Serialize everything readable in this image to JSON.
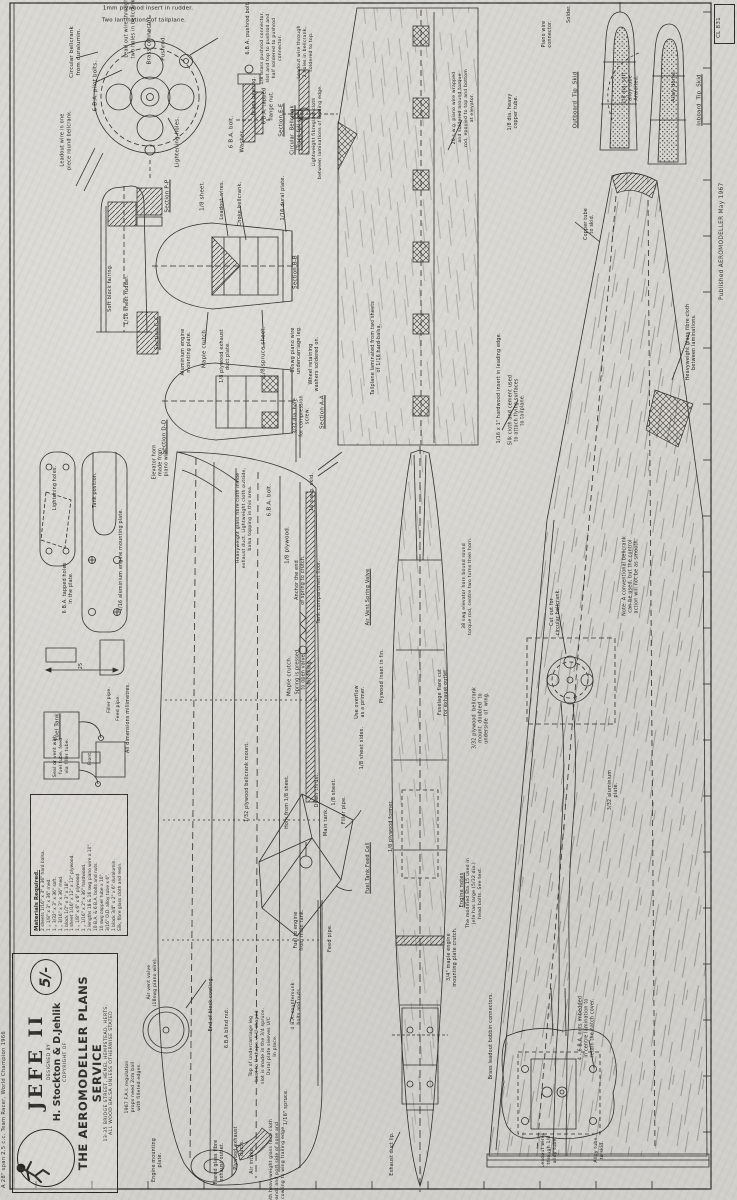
{
  "colors": {
    "paper": "#d6d4cf",
    "ink": "#2e2d2a"
  },
  "page": {
    "plan_number": "CL 831",
    "published": "Published  AEROMODELLER   May 1967",
    "margin_note": "A 28\" span 2.5 c.c. Team Racer, World Champion 1966"
  },
  "title_block": {
    "title": "JEFE II",
    "designed_by_label": "DESIGNED BY",
    "designers": "H. Stockton & D.Jehlik",
    "copyright_label": "COPYRIGHT OF",
    "service": "THE AEROMODELLER PLANS SERVICE",
    "address": "13-35 BRIDGE STREET, HEMEL HEMPSTEAD, HERTS.",
    "note": "ALL WOOD BALSA UNLESS OTHERWISE STATED",
    "price": "5/-"
  },
  "materials": {
    "heading": "Materials  Required.",
    "items": [
      "2 sheets 1/16\" x 3\" x 36\" hard balsa.",
      "1    „    1/8\" x 3\" x 36\" med.",
      "1    „    3/32\" x 3\" x 36\" soft.",
      "1    „    3/16\" x 3\" x 36\" med.",
      "1 block 1/2\" x 3\" x 18\".",
      "1 sheet 1/16\" x 12\" x 12\" plywood.",
      "1    „    1/8\" x 6\" x 6\" plywood.",
      "1    „    1/16\" x 2\" x 36\" hardwood.",
      "2 lengths 18 & 16 swg piano wire x 10\".",
      "10 B.A. & 6 B.A. bolts and nuts.",
      "10 swg copper tube x 10\".",
      "3/16\" O.D. alloy tube x 6\".",
      "1 block 3/4\" x 2\" x 6\" duralumin.",
      "Silk, fibre glass cloth and resin."
    ]
  },
  "labels": [
    {
      "t": "1mm plywood insert in rudder.",
      "x": 148,
      "y": 9,
      "r": 0
    },
    {
      "t": "Two laminations of tailplane.",
      "x": 144,
      "y": 21,
      "r": 0
    },
    {
      "t": "Circular bellcrank\nfrom duralumin.",
      "x": 76,
      "y": 52
    },
    {
      "t": "6 B.A. pilot bolts.",
      "x": 96,
      "y": 86
    },
    {
      "t": "Lead out wire through\ntwo holes in bellcrank.",
      "x": 130,
      "y": 28,
      "fs": 5
    },
    {
      "t": "Brass connector.",
      "x": 150,
      "y": 40
    },
    {
      "t": "Pushrod.",
      "x": 164,
      "y": 48
    },
    {
      "t": "Leadout wire in one\npiece round bellcrank.",
      "x": 66,
      "y": 140,
      "fs": 5
    },
    {
      "t": "Lightening holes.",
      "x": 178,
      "y": 142
    },
    {
      "t": "6.B.A. pushrod bolt.",
      "x": 248,
      "y": 28,
      "fs": 5
    },
    {
      "t": "1/8 brass pushrod connector,\nslot and top to pushrod and\nhalf soldered to pushrod\nconnector.",
      "x": 272,
      "y": 48,
      "fs": 4.6
    },
    {
      "t": "Leadout wire through\n2 holes in bellcrank,\nsoldered to top.",
      "x": 306,
      "y": 52,
      "fs": 4.6
    },
    {
      "t": "6 B.A. bolt.",
      "x": 232,
      "y": 132
    },
    {
      "t": "Washer.",
      "x": 243,
      "y": 141
    },
    {
      "t": "Brass bearing.",
      "x": 254,
      "y": 96,
      "fs": 5
    },
    {
      "t": "6 B.A. tapped\nflange nut.",
      "x": 268,
      "y": 106,
      "fs": 5
    },
    {
      "t": "Section E-E",
      "x": 282,
      "y": 120,
      "u": 1
    },
    {
      "t": "Circular  Bellcrank\n(Trace full size)",
      "x": 296,
      "y": 130,
      "fs": 5,
      "u": 1
    },
    {
      "t": "Lightweight fibreglass cloth\nbetween laminations of leading edge.",
      "x": 318,
      "y": 132,
      "fs": 4.6
    },
    {
      "t": "Section P-P",
      "x": 168,
      "y": 196,
      "u": 1
    },
    {
      "t": "1/8 sheet.",
      "x": 203,
      "y": 196
    },
    {
      "t": "Leadout wires.",
      "x": 222,
      "y": 200,
      "fs": 5
    },
    {
      "t": "Choke bellcrank.",
      "x": 240,
      "y": 204,
      "fs": 5
    },
    {
      "t": "1/16 dural plate.",
      "x": 283,
      "y": 198,
      "fs": 5
    },
    {
      "t": "Section C-C",
      "x": 158,
      "y": 333,
      "u": 1
    },
    {
      "t": "Section D-D",
      "x": 165,
      "y": 437,
      "u": 1
    },
    {
      "t": "Soft block fairing.",
      "x": 110,
      "y": 288,
      "fs": 5
    },
    {
      "t": "1/16 sheet rudder.",
      "x": 127,
      "y": 300,
      "fs": 5
    },
    {
      "t": "Aluminium engine\nmounting plate.",
      "x": 187,
      "y": 352,
      "fs": 4.8
    },
    {
      "t": "Maple crutch.",
      "x": 205,
      "y": 348
    },
    {
      "t": "1/8 plywood exhaust\nduct plate.",
      "x": 226,
      "y": 356,
      "fs": 4.8
    },
    {
      "t": "1/8 spruce sheet.",
      "x": 264,
      "y": 352
    },
    {
      "t": "10swg piano wire\nundercarriage leg.",
      "x": 297,
      "y": 350,
      "fs": 4.8
    },
    {
      "t": "Wheel retaining\nwashers soldered on.",
      "x": 315,
      "y": 364,
      "fs": 4.8
    },
    {
      "t": "Section B-B",
      "x": 296,
      "y": 272,
      "u": 1
    },
    {
      "t": "Section A-A",
      "x": 323,
      "y": 412,
      "u": 1
    },
    {
      "t": "3/32 dia. hole\nfor compression\nscrew.",
      "x": 303,
      "y": 416,
      "fs": 4.8
    },
    {
      "t": "Tailplane laminated from two sheets\nof 1/16 hard balsa.",
      "x": 377,
      "y": 348,
      "fs": 4.8
    },
    {
      "t": "20 s.w.g. piano wire wrapped\nand soldered around torque\nrod, epoxied to top and bottom\nat elevator.",
      "x": 464,
      "y": 108,
      "fs": 4.6
    },
    {
      "t": "Piano wire\nconnector.",
      "x": 548,
      "y": 34,
      "fs": 4.8
    },
    {
      "t": "Solder.",
      "x": 570,
      "y": 14,
      "fs": 4.8
    },
    {
      "t": "1/8 dia. heavy\ncopper tube.",
      "x": 514,
      "y": 112,
      "fs": 4.8
    },
    {
      "t": "Outboard  Tip  Skid",
      "x": 576,
      "y": 100,
      "u": 1
    },
    {
      "t": "Inboard  Tip  Skid",
      "x": 700,
      "y": 100,
      "u": 1
    },
    {
      "t": "1/8 dia. soft\nalloy tube\nAraldited.",
      "x": 632,
      "y": 88,
      "fs": 4.8
    },
    {
      "t": "Alloy dome.",
      "x": 674,
      "y": 86,
      "fs": 5
    },
    {
      "t": "Copper tube\nto skid.",
      "x": 590,
      "y": 224,
      "fs": 4.8
    },
    {
      "t": "Heavyweight glass fibre cloth\nbetween laminations.",
      "x": 692,
      "y": 342,
      "fs": 4.8
    },
    {
      "t": "1/16 x 1\" hardwood insert in leading edge.",
      "x": 500,
      "y": 388,
      "fs": 4.8
    },
    {
      "t": "Silk cloth and cement used\nto attach flying surfaces\nto tailplane.",
      "x": 518,
      "y": 410,
      "fs": 4.8
    },
    {
      "t": "Note: A conventional bellcrank\ncan be used, but the control\naction will not be as smooth.",
      "x": 632,
      "y": 576,
      "fs": 4.8
    },
    {
      "t": "Cut out for\ncircular bellcrank.",
      "x": 556,
      "y": 612,
      "fs": 4.8
    },
    {
      "t": "38 swg elevator horn bound round\ntorque rod, centre two turns then horn.",
      "x": 468,
      "y": 586,
      "fs": 4.6
    },
    {
      "t": "3/32 plywood  bellcrank\nmount  doubled  to\nunderside  of  wing.",
      "x": 482,
      "y": 718,
      "fs": 4.8
    },
    {
      "t": "3/32 aluminium\nplate.",
      "x": 614,
      "y": 790,
      "fs": 4.8
    },
    {
      "t": "Elevator horn\nmade from\npiano wire.",
      "x": 162,
      "y": 462,
      "fs": 4.8
    },
    {
      "t": "Heavyweight glass fibre cloth inside\nexhaust duct. Lightweight cloth outside,\nbalsa topping in this area.",
      "x": 245,
      "y": 518,
      "fs": 4.6
    },
    {
      "t": "6.B.A. bolt.",
      "x": 270,
      "y": 500
    },
    {
      "t": "16 s.w.g. skid.",
      "x": 312,
      "y": 492,
      "fs": 5
    },
    {
      "t": "1/8 plywood.",
      "x": 288,
      "y": 545
    },
    {
      "t": "Anchor the end\nof spring to crutch.",
      "x": 301,
      "y": 580,
      "fs": 4.8
    },
    {
      "t": "Tank compartment floor.",
      "x": 320,
      "y": 592,
      "fs": 4.8
    },
    {
      "t": "Maple crutch.",
      "x": 290,
      "y": 676
    },
    {
      "t": "Spring is pressed\nto open valve\nfor filling.",
      "x": 305,
      "y": 672,
      "fs": 4.8
    },
    {
      "t": "Use overflow\nas a primer.",
      "x": 361,
      "y": 702,
      "fs": 4.8
    },
    {
      "t": "Air Vent Spring Valve",
      "x": 368,
      "y": 597,
      "u": 1,
      "fs": 5
    },
    {
      "t": "Plywood inset in fin.",
      "x": 382,
      "y": 676,
      "fs": 5
    },
    {
      "t": "Fuselage flare cut\nfor exhaust outlet.",
      "x": 444,
      "y": 692,
      "fs": 4.8
    },
    {
      "t": "1/8 sheet sides.",
      "x": 362,
      "y": 748,
      "fs": 5
    },
    {
      "t": "Down thrust.",
      "x": 317,
      "y": 790,
      "fs": 5
    },
    {
      "t": "1/8 sheet.",
      "x": 334,
      "y": 792,
      "fs": 5
    },
    {
      "t": "Main tank.",
      "x": 326,
      "y": 822,
      "fs": 5
    },
    {
      "t": "Filler pipe.",
      "x": 344,
      "y": 810,
      "fs": 5
    },
    {
      "t": "Fuel Tank Feed Cell",
      "x": 368,
      "y": 868,
      "u": 1,
      "fs": 5
    },
    {
      "t": "1/32 plywood bellcrank mount.",
      "x": 248,
      "y": 782,
      "fs": 4.8
    },
    {
      "t": "Horn from 1/8 sheet.",
      "x": 288,
      "y": 802,
      "fs": 4.8
    },
    {
      "t": "Fuel to engine\nfrom main tank.",
      "x": 300,
      "y": 930,
      "fs": 4.8
    },
    {
      "t": "Feed pipe.",
      "x": 330,
      "y": 938,
      "fs": 5
    },
    {
      "t": "1/8 plywood former.",
      "x": 392,
      "y": 826,
      "fs": 4.8
    },
    {
      "t": "Engine notes",
      "x": 462,
      "y": 890,
      "u": 1,
      "fs": 5
    },
    {
      "t": "The modified Eta 15 used in\nJefe has large (5/32 dia.)\nhead bolts. See text.",
      "x": 475,
      "y": 893,
      "fs": 4.6
    },
    {
      "t": "3/4\" maple engine\nmounting plate crutch.",
      "x": 453,
      "y": 957,
      "fs": 4.8
    },
    {
      "t": "Brass leadout bobbin connectors.",
      "x": 492,
      "y": 1036,
      "fs": 4.8
    },
    {
      "t": "4 - 6 B.A. nuts imbedded\nin centre lamination to\nretain the hatch cover.",
      "x": 588,
      "y": 1028,
      "fs": 4.8
    },
    {
      "t": "Leadout wires\nthrough 1/8\nalloy tube.",
      "x": 550,
      "y": 1150,
      "fs": 4.6
    },
    {
      "t": "Alloy tube\nto skid.",
      "x": 600,
      "y": 1150,
      "fs": 4.6
    },
    {
      "t": "Engine mounting\nplate.",
      "x": 158,
      "y": 1160,
      "fs": 4.8
    },
    {
      "t": "Flared glass fibre\nexhaust outlet.",
      "x": 220,
      "y": 1162,
      "fs": 4.8
    },
    {
      "t": "Plywood exhaust\nducts.",
      "x": 240,
      "y": 1148,
      "fs": 4.8
    },
    {
      "t": "Air intake.",
      "x": 252,
      "y": 1160,
      "fs": 5
    },
    {
      "t": "6.B.A blind nut.",
      "x": 228,
      "y": 1028,
      "fs": 4.8
    },
    {
      "t": "1/16\" spruce.",
      "x": 286,
      "y": 1107,
      "fs": 5
    },
    {
      "t": "Both heavyweight glass fibre cloth\nbands and port side of nose and\ncowling to wing trailing edge.",
      "x": 278,
      "y": 1162,
      "fs": 4.6
    },
    {
      "t": "1967 F.A.I. regulation\nprops need 2cm ball\nwith filleted edges.",
      "x": 134,
      "y": 1087,
      "fs": 4.6
    },
    {
      "t": "Air vent valve\n(18swg piano wire).",
      "x": 153,
      "y": 982,
      "fs": 4.6
    },
    {
      "t": "Top of undercarriage leg\nbent to U-shape. A U-shaped\nslot is made in the 3/4 spruce.\nDural plate sleeves U/C\nin place.",
      "x": 264,
      "y": 1046,
      "fs": 4.6
    },
    {
      "t": "4 B.A. countersunk\nbolts and nuts.",
      "x": 297,
      "y": 1006,
      "fs": 4.6
    },
    {
      "t": "End of block cowling.",
      "x": 212,
      "y": 1004,
      "fs": 4.8
    },
    {
      "t": "Exhaust duct lip.",
      "x": 393,
      "y": 1154,
      "fs": 4.8
    },
    {
      "t": "1/16 aluminium engine mounting plate.",
      "x": 122,
      "y": 560,
      "fs": 4.8
    },
    {
      "t": "6 B.A. tapped holes\nin the plate.",
      "x": 69,
      "y": 588,
      "fs": 4.8
    },
    {
      "t": "Tank position.",
      "x": 96,
      "y": 490,
      "fs": 4.8
    },
    {
      "t": "Lightening holes.",
      "x": 56,
      "y": 488,
      "fs": 4.8
    },
    {
      "t": "25",
      "x": 82,
      "y": 666,
      "fs": 4.8
    },
    {
      "t": "All dimensions millimetres.",
      "x": 129,
      "y": 718,
      "fs": 4.8
    },
    {
      "t": "Fuel Tank",
      "x": 58,
      "y": 727,
      "u": 1,
      "fs": 5.5
    },
    {
      "t": "Seal or vent with\nfuel tube, feed\nvia filler tube.",
      "x": 62,
      "y": 756,
      "fs": 4.6
    },
    {
      "t": "Front.",
      "x": 91,
      "y": 758,
      "fs": 4.4
    },
    {
      "t": "Filler pipe.",
      "x": 110,
      "y": 700,
      "fs": 4.6
    },
    {
      "t": "Feed pipe.",
      "x": 119,
      "y": 708,
      "fs": 4.6
    }
  ]
}
